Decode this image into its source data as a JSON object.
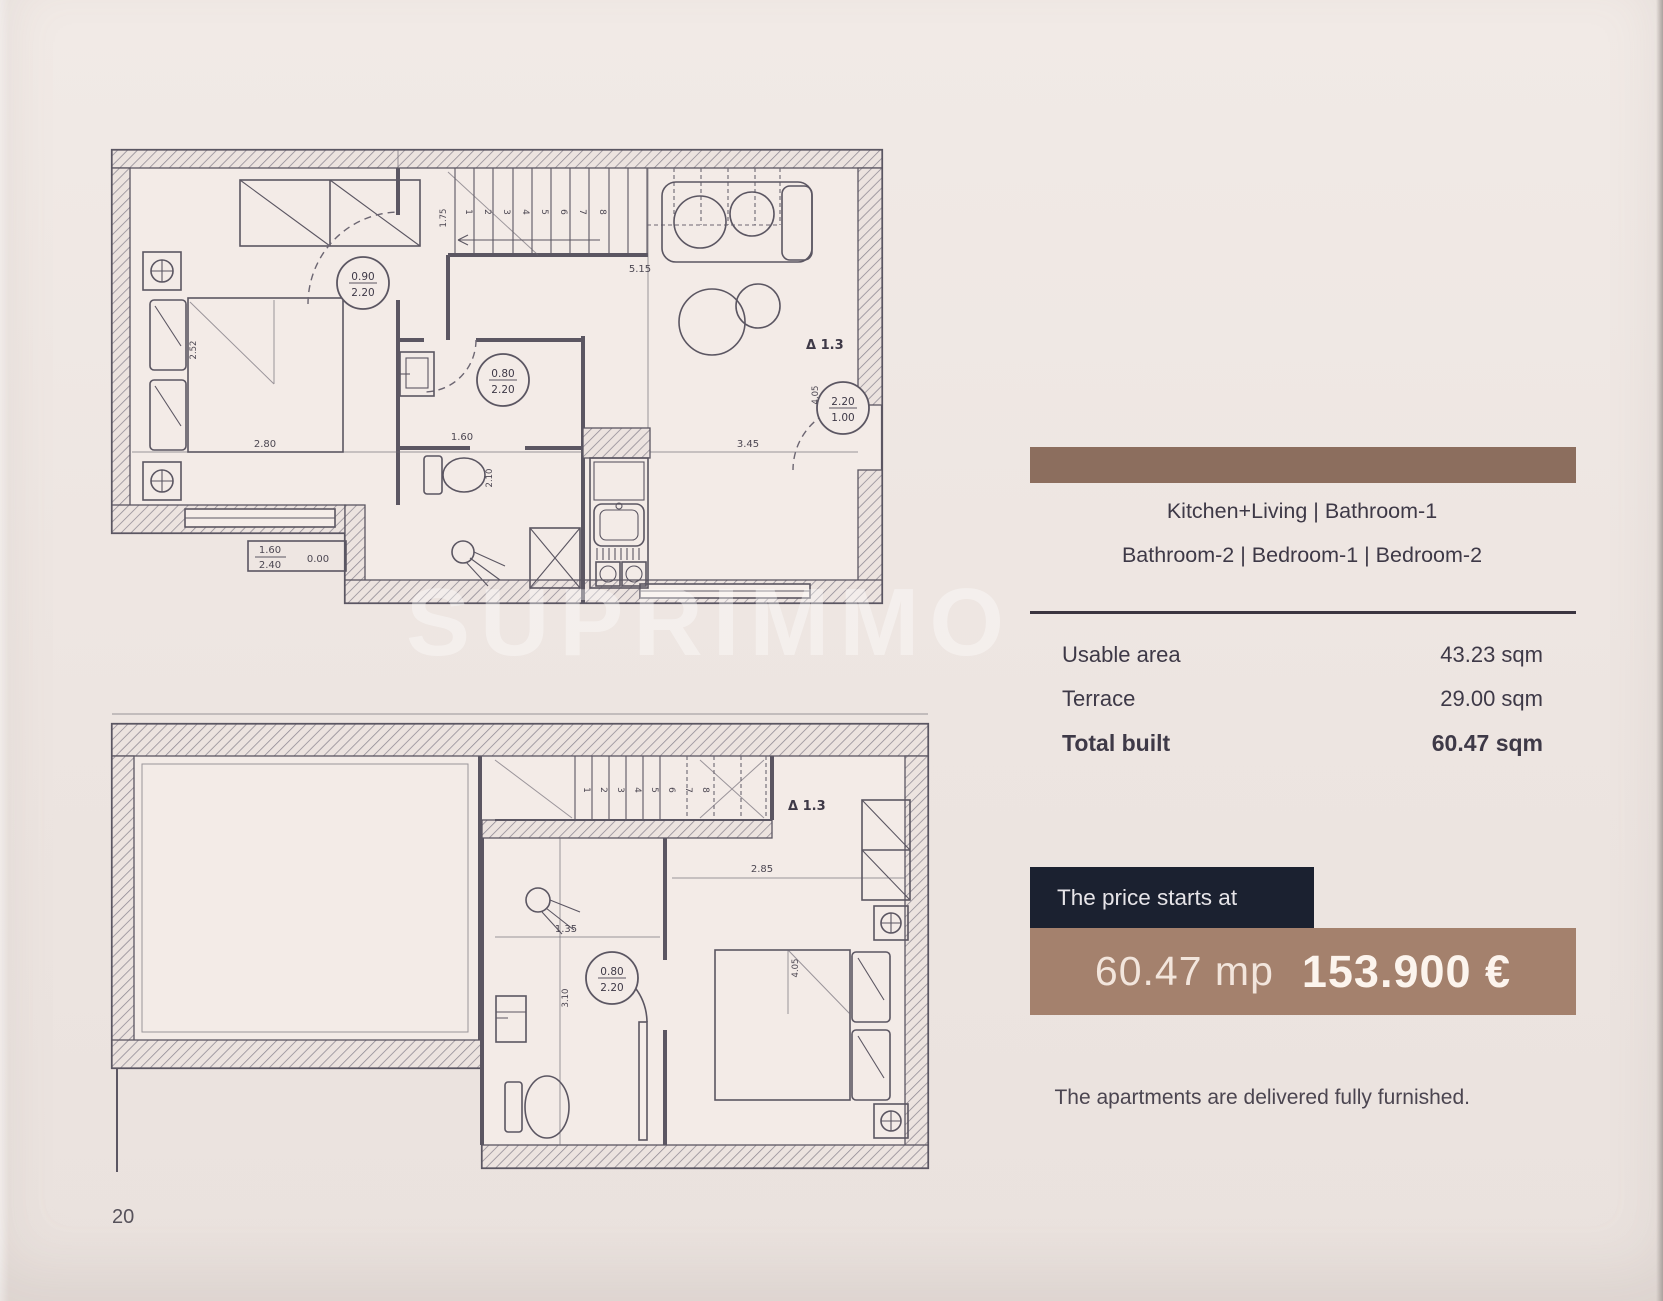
{
  "page": {
    "number": "20",
    "watermark": "SUPRIMMO"
  },
  "panel": {
    "colors": {
      "accent_brown": "#8c6e5e",
      "price_brown": "#a4816d",
      "navy": "#1b2130"
    },
    "rooms_line1": "Kitchen+Living   |   Bathroom-1",
    "rooms_line2": "Bathroom-2  |  Bedroom-1  |  Bedroom-2",
    "areas": {
      "rows": [
        {
          "label": "Usable area",
          "value": "43.23 sqm"
        },
        {
          "label": "Terrace",
          "value": "29.00 sqm"
        },
        {
          "label": "Total built",
          "value": "60.47 sqm"
        }
      ]
    },
    "price": {
      "intro": "The price starts at",
      "size": "60.47 mp",
      "amount": "153.900 €"
    },
    "note": "The apartments are delivered fully furnished."
  },
  "plan_upper": {
    "level_label": "Δ 1.3",
    "door_main_w": "0.90",
    "door_main_h": "2.20",
    "door_bath_w": "0.80",
    "door_bath_h": "2.20",
    "door_balcony_w": "2.20",
    "door_balcony_h": "1.00",
    "dim_bed": "2.80",
    "dim_bed_v": "2.52",
    "dim_bath": "1.60",
    "dim_bath_v": "2.10",
    "dim_living": "3.45",
    "dim_living_v": "4.05",
    "dim_stairs": "5.15",
    "dim_hall_v": "1.75",
    "elev_top": "1.60",
    "elev_bottom": "2.40",
    "elev_level": "0.00",
    "stairs": [
      "1",
      "2",
      "3",
      "4",
      "5",
      "6",
      "7",
      "8"
    ]
  },
  "plan_lower": {
    "level_label": "Δ 1.3",
    "door_bath_w": "0.80",
    "door_bath_h": "2.20",
    "dim_bedroom": "2.85",
    "dim_bedroom_v": "4.05",
    "dim_bath": "1.35",
    "dim_bath_v": "3.10",
    "stairs": [
      "1",
      "2",
      "3",
      "4",
      "5",
      "6",
      "7",
      "8"
    ]
  }
}
